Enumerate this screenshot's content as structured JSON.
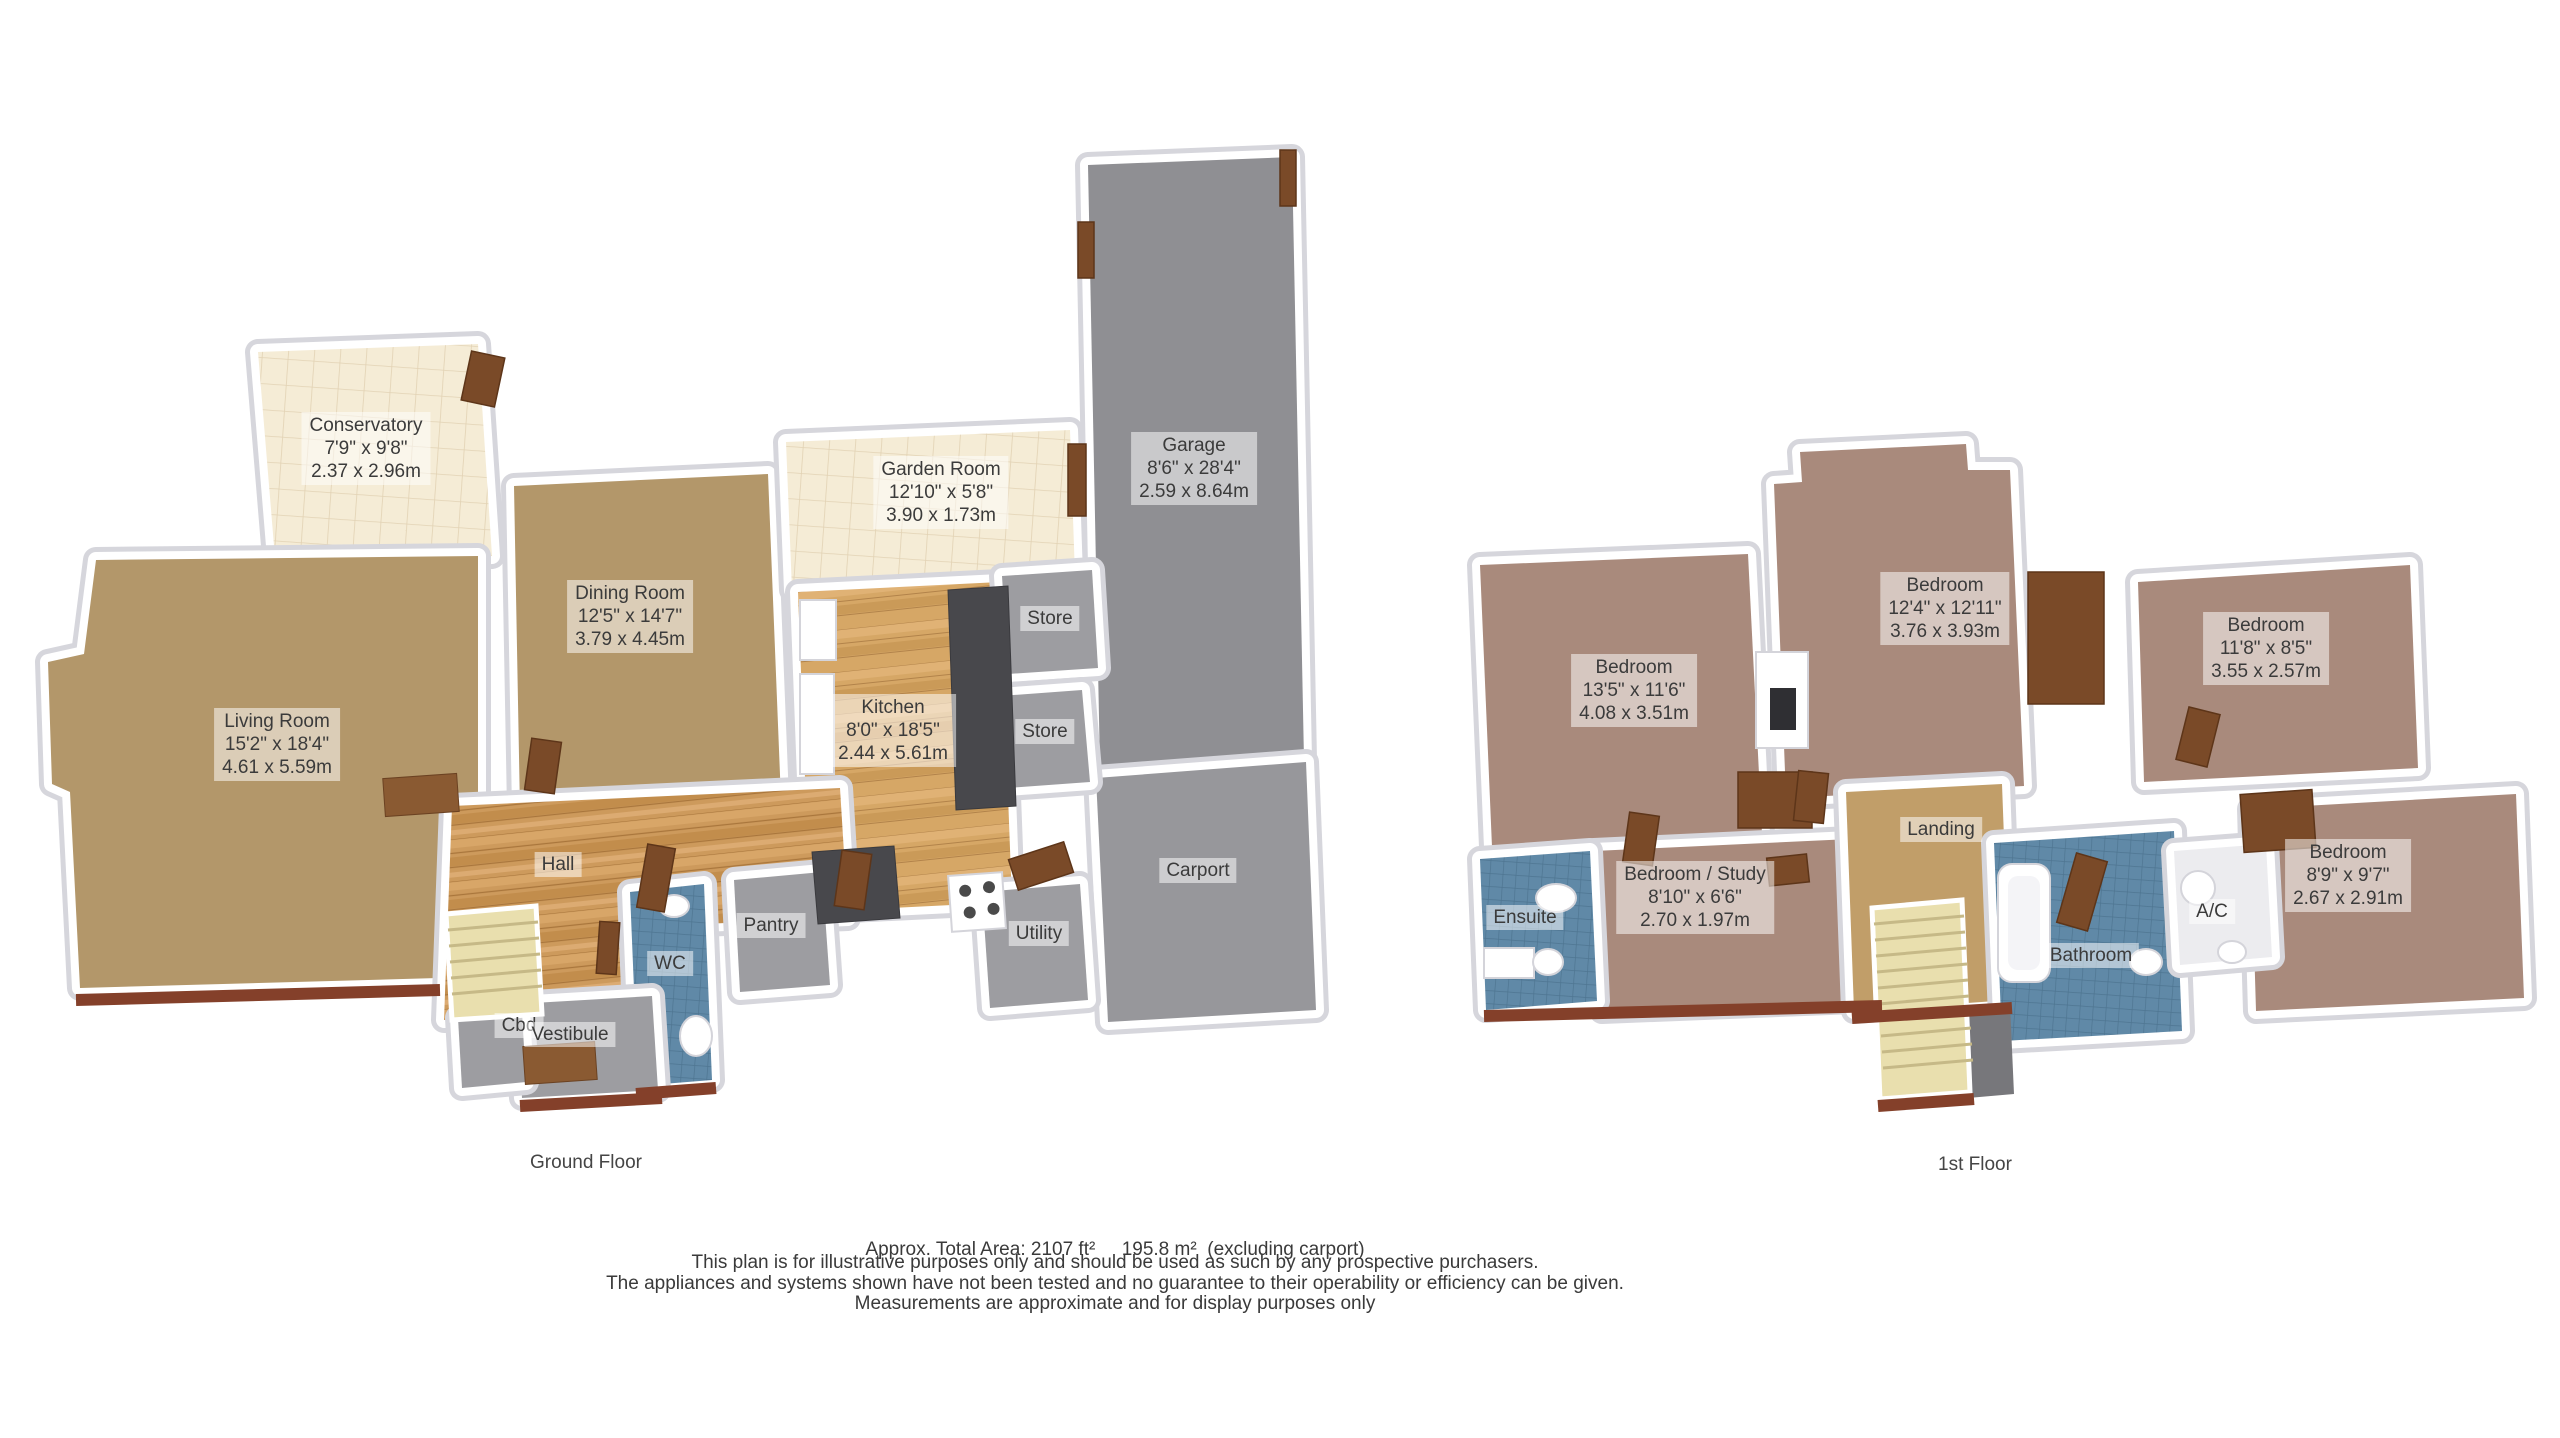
{
  "ground_floor": {
    "title": "Ground Floor",
    "rooms": {
      "conservatory": {
        "name": "Conservatory",
        "imperial": "7'9\" x 9'8\"",
        "metric": "2.37 x 2.96m"
      },
      "living_room": {
        "name": "Living Room",
        "imperial": "15'2\" x 18'4\"",
        "metric": "4.61 x 5.59m"
      },
      "dining_room": {
        "name": "Dining Room",
        "imperial": "12'5\" x 14'7\"",
        "metric": "3.79 x 4.45m"
      },
      "garden_room": {
        "name": "Garden Room",
        "imperial": "12'10\" x 5'8\"",
        "metric": "3.90 x 1.73m"
      },
      "garage": {
        "name": "Garage",
        "imperial": "8'6\" x 28'4\"",
        "metric": "2.59 x 8.64m"
      },
      "kitchen": {
        "name": "Kitchen",
        "imperial": "8'0\" x 18'5\"",
        "metric": "2.44 x 5.61m"
      },
      "store_upper": {
        "name": "Store"
      },
      "store_lower": {
        "name": "Store"
      },
      "hall": {
        "name": "Hall"
      },
      "pantry": {
        "name": "Pantry"
      },
      "wc": {
        "name": "WC"
      },
      "cbd": {
        "name": "Cbd"
      },
      "vestibule": {
        "name": "Vestibule"
      },
      "utility": {
        "name": "Utility"
      },
      "carport": {
        "name": "Carport"
      }
    }
  },
  "first_floor": {
    "title": "1st Floor",
    "rooms": {
      "bedroom_1": {
        "name": "Bedroom",
        "imperial": "13'5\" x 11'6\"",
        "metric": "4.08 x 3.51m"
      },
      "bedroom_2": {
        "name": "Bedroom",
        "imperial": "12'4\" x 12'11\"",
        "metric": "3.76 x 3.93m"
      },
      "bedroom_3": {
        "name": "Bedroom",
        "imperial": "11'8\" x 8'5\"",
        "metric": "3.55 x 2.57m"
      },
      "bedroom_4": {
        "name": "Bedroom",
        "imperial": "8'9\" x 9'7\"",
        "metric": "2.67 x 2.91m"
      },
      "bedroom_study": {
        "name": "Bedroom / Study",
        "imperial": "8'10\" x 6'6\"",
        "metric": "2.70 x 1.97m"
      },
      "ensuite": {
        "name": "Ensuite"
      },
      "landing": {
        "name": "Landing"
      },
      "bathroom": {
        "name": "Bathroom"
      },
      "ac": {
        "name": "A/C"
      }
    }
  },
  "footer": {
    "area": "Approx. Total Area: 2107 ft²     195.8 m²  (excluding carport)",
    "line1": "This plan is for illustrative purposes only and should be used as such by any prospective purchasers.",
    "line2": "The appliances and systems shown have not been tested and no guarantee to their operability or efficiency can be given.",
    "line3": "Measurements are approximate and for display purposes only"
  },
  "colors": {
    "carpet_tan": "#b3976a",
    "wood_hall": "#cd9a5c",
    "wood_kitchen": "#d6a766",
    "tile_cream": "#f5ecd6",
    "tile_blue": "#6089a7",
    "carpet_mauve": "#a98a7c",
    "carpet_landing": "#c19e69",
    "concrete_garage": "#8f8f93",
    "concrete_carport": "#97979b",
    "store_gray": "#9d9da1",
    "stairs_pale": "#e9dfae",
    "door_brown": "#7a4a28",
    "wall_white": "#ffffff"
  }
}
